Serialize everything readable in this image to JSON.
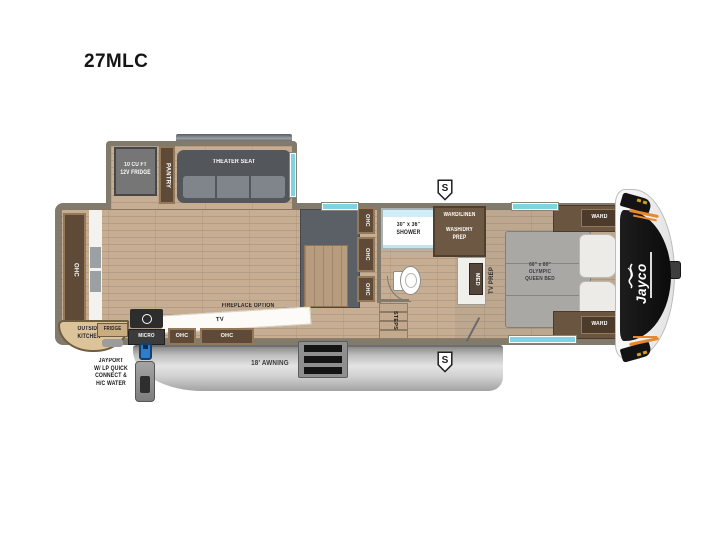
{
  "title": "27MLC",
  "slideout": {
    "fridge_label": "10 CU FT\n12V FRIDGE",
    "pantry_label": "PANTRY",
    "theater_label": "THEATER SEAT"
  },
  "living": {
    "rear_cabinet_label": "OHC",
    "fireplace_label": "FIREPLACE OPTION",
    "tv_label": "TV",
    "ohc_small_label": "OHC",
    "ohc_large_label": "OHC",
    "micro_label": "MICRO",
    "outside_fridge_label": "FRIDGE",
    "outside_kitchen_label": "OUTSIDE\nKITCHEN"
  },
  "kitchen": {
    "ohc_labels": [
      "OHC",
      "OHC",
      "OHC"
    ]
  },
  "bath": {
    "shower_label": "30\" x 36\"\nSHOWER",
    "ward_linen_label": "WARD/LINEN",
    "wash_dry_label": "WASH/DRY\nPREP",
    "med_label": "MED",
    "steps_label": "STEPS"
  },
  "bedroom": {
    "tv_prep_label": "TV PREP",
    "bed_label": "66\" x 80\"\nOLYMPIC\nQUEEN BED",
    "ward_top_label": "WARD",
    "ward_bottom_label": "WARD"
  },
  "exterior": {
    "awning_label": "18' AWNING",
    "jayport_label": "JAYPORT\nW/ LP QUICK\nCONNECT &\nH/C WATER",
    "safety_badge": "S",
    "brand": "Jayco"
  },
  "colors": {
    "floor_tan": "#c7ae93",
    "cabinet_brown": "#5e4a36",
    "accent_teal": "#7fd4e4",
    "cap_black": "#131313",
    "cap_orange": "#e8872c",
    "jayport_blue": "#2e7ccc"
  }
}
